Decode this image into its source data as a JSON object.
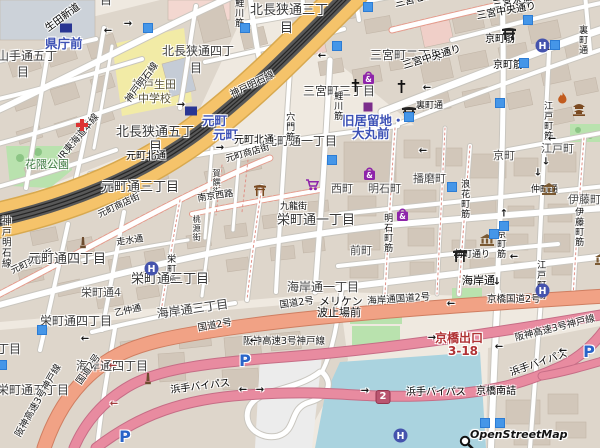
{
  "attribution": "OpenStreetMap",
  "colors": {
    "station_blue": "#3d51b5",
    "trunk_orange": "#f5c36a",
    "primary_salmon": "#f1a285",
    "motorway_pink": "#e88ba0",
    "water_blue": "#aad3df",
    "park_green": "#b9e2ae",
    "school_yellow": "#f2eba6",
    "poi_blue": "#4596e8",
    "shopping_purple": "#8e24aa",
    "exit_red": "#b03235"
  },
  "labels": [
    {
      "t": "山手通五丁",
      "x": -3,
      "y": 50,
      "c": "d12"
    },
    {
      "t": "目",
      "x": 17,
      "y": 66,
      "c": "d12"
    },
    {
      "t": "県庁前",
      "x": 45,
      "y": 38,
      "c": "stn"
    },
    {
      "t": "目",
      "x": 100,
      "y": -6,
      "c": "d12"
    },
    {
      "t": "北長狭通四丁",
      "x": 162,
      "y": 45,
      "c": "d12"
    },
    {
      "t": "目",
      "x": 190,
      "y": 62,
      "c": "d12"
    },
    {
      "t": "北長狭通三丁",
      "x": 250,
      "y": 4,
      "c": "d13"
    },
    {
      "t": "目",
      "x": 280,
      "y": 22,
      "c": "d13"
    },
    {
      "t": "生田新道",
      "x": 44,
      "y": 26,
      "c": "st10",
      "r": -36
    },
    {
      "t": "神戸生田",
      "x": 132,
      "y": 79,
      "c": "sch"
    },
    {
      "t": "中学校",
      "x": 138,
      "y": 93,
      "c": "sch"
    },
    {
      "t": "北長狭通五丁",
      "x": 116,
      "y": 126,
      "c": "d13"
    },
    {
      "t": "目",
      "x": 149,
      "y": 141,
      "c": "d13"
    },
    {
      "t": "三宮町二丁目",
      "x": 370,
      "y": 49,
      "c": "d12"
    },
    {
      "t": "三宮町三丁目",
      "x": 303,
      "y": 85,
      "c": "d12"
    },
    {
      "t": "三宮センター街",
      "x": 394,
      "y": 0,
      "c": "st10",
      "r": -13
    },
    {
      "t": "三宮本通",
      "x": 492,
      "y": 1,
      "c": "st10",
      "r": -8
    },
    {
      "t": "三宮中央通り",
      "x": 402,
      "y": 62,
      "c": "st10",
      "r": -17
    },
    {
      "t": "三宮中央通り",
      "x": 476,
      "y": 12,
      "c": "st10",
      "r": -10
    },
    {
      "t": "京町筋",
      "x": 485,
      "y": 35,
      "c": "st10"
    },
    {
      "t": "京町筋",
      "x": 493,
      "y": 61,
      "c": "st10"
    },
    {
      "t": "裏町通",
      "x": 577,
      "y": 25,
      "c": "st9",
      "v": 1
    },
    {
      "t": "裏町通",
      "x": 416,
      "y": 102,
      "c": "st9"
    },
    {
      "t": "鯉川筋",
      "x": 233,
      "y": -2,
      "c": "st9",
      "v": 1
    },
    {
      "t": "元町",
      "x": 202,
      "y": 115,
      "c": "stn"
    },
    {
      "t": "元町",
      "x": 213,
      "y": 129,
      "c": "stn"
    },
    {
      "t": "神戸明石線",
      "x": 124,
      "y": 99,
      "c": "rail",
      "r": -53
    },
    {
      "t": "神戸明石線",
      "x": 229,
      "y": 91,
      "c": "rail",
      "r": -26
    },
    {
      "t": "JR東海道本線",
      "x": 57,
      "y": 156,
      "c": "rail",
      "r": -50
    },
    {
      "t": "神戸明石線",
      "x": 0,
      "y": 216,
      "c": "rail",
      "v": 1
    },
    {
      "t": "旧居留地・",
      "x": 342,
      "y": 115,
      "c": "stn"
    },
    {
      "t": "大丸前",
      "x": 352,
      "y": 128,
      "c": "stn"
    },
    {
      "t": "元町通一丁目",
      "x": 265,
      "y": 135,
      "c": "d12"
    },
    {
      "t": "元町北通",
      "x": 126,
      "y": 152,
      "c": "st10"
    },
    {
      "t": "元町北通",
      "x": 234,
      "y": 136,
      "c": "st10"
    },
    {
      "t": "元町通三丁目",
      "x": 101,
      "y": 181,
      "c": "d13"
    },
    {
      "t": "花隈公園",
      "x": 25,
      "y": 159,
      "c": "park"
    },
    {
      "t": "元町商店街",
      "x": 225,
      "y": 156,
      "c": "st9",
      "r": -16
    },
    {
      "t": "元町商店街",
      "x": 97,
      "y": 212,
      "c": "st9",
      "r": -25
    },
    {
      "t": "元町商店街",
      "x": 10,
      "y": 268,
      "c": "st9",
      "r": -25
    },
    {
      "t": "穴門筋",
      "x": 284,
      "y": 112,
      "c": "st9",
      "v": 1
    },
    {
      "t": "鯉川筋",
      "x": 332,
      "y": 91,
      "c": "st9",
      "v": 1
    },
    {
      "t": "賀饌街",
      "x": 212,
      "y": 169,
      "c": "st8",
      "v": 1
    },
    {
      "t": "桃源街",
      "x": 192,
      "y": 215,
      "c": "st8",
      "v": 1
    },
    {
      "t": "南京西路",
      "x": 197,
      "y": 195,
      "c": "st9",
      "r": -8
    },
    {
      "t": "九龍街",
      "x": 280,
      "y": 203,
      "c": "st9"
    },
    {
      "t": "西町",
      "x": 331,
      "y": 183,
      "c": "d11"
    },
    {
      "t": "明石町",
      "x": 368,
      "y": 183,
      "c": "d11"
    },
    {
      "t": "播磨町",
      "x": 413,
      "y": 173,
      "c": "d11"
    },
    {
      "t": "京町",
      "x": 493,
      "y": 150,
      "c": "d11"
    },
    {
      "t": "江戸町",
      "x": 541,
      "y": 143,
      "c": "d11"
    },
    {
      "t": "伊藤町",
      "x": 568,
      "y": 194,
      "c": "d11"
    },
    {
      "t": "浪花町筋",
      "x": 459,
      "y": 179,
      "c": "st9",
      "v": 1
    },
    {
      "t": "明石町筋",
      "x": 382,
      "y": 213,
      "c": "st9",
      "v": 1
    },
    {
      "t": "江戸町筋",
      "x": 542,
      "y": 101,
      "c": "st9",
      "v": 1
    },
    {
      "t": "江戸町筋",
      "x": 535,
      "y": 260,
      "c": "st9",
      "v": 1
    },
    {
      "t": "伊藤町筋",
      "x": 573,
      "y": 207,
      "c": "st9",
      "v": 1
    },
    {
      "t": "京町筋",
      "x": 495,
      "y": 229,
      "c": "st9",
      "v": 1
    },
    {
      "t": "仲町通",
      "x": 531,
      "y": 186,
      "c": "st9"
    },
    {
      "t": "栄町通一丁目",
      "x": 277,
      "y": 214,
      "c": "d13"
    },
    {
      "t": "前町",
      "x": 350,
      "y": 245,
      "c": "d11"
    },
    {
      "t": "前町通り",
      "x": 454,
      "y": 251,
      "c": "st9"
    },
    {
      "t": "海岸通",
      "x": 462,
      "y": 275,
      "c": "st11"
    },
    {
      "t": "海岸通一丁目",
      "x": 287,
      "y": 281,
      "c": "d12"
    },
    {
      "t": "走水通",
      "x": 116,
      "y": 239,
      "c": "st9",
      "r": -8
    },
    {
      "t": "栄町通",
      "x": 165,
      "y": 254,
      "c": "st9",
      "v": 1
    },
    {
      "t": "元町通四丁目",
      "x": 28,
      "y": 253,
      "c": "d13"
    },
    {
      "t": "栄町通三丁目",
      "x": 131,
      "y": 273,
      "c": "d13"
    },
    {
      "t": "栄町通4",
      "x": 81,
      "y": 287,
      "c": "d11"
    },
    {
      "t": "栄町通四丁目",
      "x": 40,
      "y": 315,
      "c": "d12"
    },
    {
      "t": "乙仲通",
      "x": 114,
      "y": 310,
      "c": "st9",
      "r": -12
    },
    {
      "t": "海岸通三丁目",
      "x": 156,
      "y": 308,
      "c": "d12",
      "r": -8
    },
    {
      "t": "丁目",
      "x": -3,
      "y": 343,
      "c": "d12"
    },
    {
      "t": "海岸通四丁目",
      "x": 76,
      "y": 360,
      "c": "d12"
    },
    {
      "t": "栄町通五丁目",
      "x": -3,
      "y": 384,
      "c": "d12"
    },
    {
      "t": "国道2号",
      "x": 279,
      "y": 301,
      "c": "rail",
      "r": -8
    },
    {
      "t": "国道2号",
      "x": 197,
      "y": 324,
      "c": "rail",
      "r": -10
    },
    {
      "t": "国道2号",
      "x": 75,
      "y": 381,
      "c": "rail",
      "r": -55
    },
    {
      "t": "海岸通国道2号",
      "x": 367,
      "y": 297,
      "c": "rail",
      "r": -4
    },
    {
      "t": "京橋国道2号",
      "x": 487,
      "y": 295,
      "c": "rail"
    },
    {
      "t": "メリケン",
      "x": 319,
      "y": 296,
      "c": "blk11"
    },
    {
      "t": "波止場前",
      "x": 317,
      "y": 307,
      "c": "blk11"
    },
    {
      "t": "阪神高速3号神戸線",
      "x": 243,
      "y": 337,
      "c": "rail"
    },
    {
      "t": "阪神高速3号神戸線",
      "x": 514,
      "y": 334,
      "c": "rail",
      "r": -14
    },
    {
      "t": "阪神高速3号神戸線",
      "x": 14,
      "y": 434,
      "c": "rail",
      "r": -60
    },
    {
      "t": "京橋出口",
      "x": 435,
      "y": 332,
      "c": "red"
    },
    {
      "t": "3-18",
      "x": 448,
      "y": 345,
      "c": "red"
    },
    {
      "t": "浜手バイパス",
      "x": 170,
      "y": 386,
      "c": "st10",
      "r": -7
    },
    {
      "t": "浜手バイパス",
      "x": 406,
      "y": 388,
      "c": "st10"
    },
    {
      "t": "浜手バイパス",
      "x": 509,
      "y": 369,
      "c": "st10",
      "r": -19
    },
    {
      "t": "京橋南詰",
      "x": 476,
      "y": 387,
      "c": "st10"
    }
  ],
  "icons": [
    {
      "n": "hospital-icon",
      "x": 76,
      "y": 119
    },
    {
      "n": "railway-station-icon",
      "x": 66,
      "y": 28
    },
    {
      "n": "railway-station-icon",
      "x": 191,
      "y": 111
    },
    {
      "n": "hotel-icon",
      "x": 535,
      "y": 38
    },
    {
      "n": "hotel-icon",
      "x": 144,
      "y": 261
    },
    {
      "n": "hotel-icon",
      "x": 535,
      "y": 283
    },
    {
      "n": "hotel-icon",
      "x": 393,
      "y": 428
    },
    {
      "n": "museum-icon",
      "x": 542,
      "y": 183
    },
    {
      "n": "museum-icon",
      "x": 480,
      "y": 234
    },
    {
      "n": "museum-icon",
      "x": 595,
      "y": 253
    },
    {
      "n": "shrine-torii-icon",
      "x": 501,
      "y": 27
    },
    {
      "n": "shrine-torii-icon",
      "x": 401,
      "y": 106
    },
    {
      "n": "shrine-torii-icon",
      "x": 452,
      "y": 249
    },
    {
      "n": "chinatown-gate-icon",
      "x": 253,
      "y": 184
    },
    {
      "n": "church-icon",
      "x": 351,
      "y": 79
    },
    {
      "n": "church-icon",
      "x": 397,
      "y": 80
    },
    {
      "n": "fire-station-icon",
      "x": 557,
      "y": 92
    },
    {
      "n": "temple-icon",
      "x": 572,
      "y": 103
    },
    {
      "n": "shopping-bag-icon",
      "x": 362,
      "y": 70
    },
    {
      "n": "shopping-bag-icon",
      "x": 363,
      "y": 166
    },
    {
      "n": "shopping-bag-icon",
      "x": 396,
      "y": 207
    },
    {
      "n": "supermarket-cart-icon",
      "x": 305,
      "y": 179
    },
    {
      "n": "parking-icon",
      "x": 245,
      "y": 361
    },
    {
      "n": "parking-icon",
      "x": 125,
      "y": 437
    },
    {
      "n": "parking-icon",
      "x": 589,
      "y": 352
    },
    {
      "n": "monument-icon",
      "x": 79,
      "y": 237
    },
    {
      "n": "monument-icon",
      "x": 144,
      "y": 373
    },
    {
      "n": "poi-purple-icon",
      "x": 368,
      "y": 107
    },
    {
      "n": "poi-square-icon",
      "x": 148,
      "y": 28
    },
    {
      "n": "poi-square-icon",
      "x": 245,
      "y": 28
    },
    {
      "n": "poi-square-icon",
      "x": 368,
      "y": 7
    },
    {
      "n": "poi-square-icon",
      "x": 337,
      "y": 46
    },
    {
      "n": "poi-square-icon",
      "x": 528,
      "y": 20
    },
    {
      "n": "poi-square-icon",
      "x": 555,
      "y": 45
    },
    {
      "n": "poi-square-icon",
      "x": 500,
      "y": 103
    },
    {
      "n": "poi-square-icon",
      "x": 409,
      "y": 117
    },
    {
      "n": "poi-square-icon",
      "x": 452,
      "y": 187
    },
    {
      "n": "poi-square-icon",
      "x": 504,
      "y": 226
    },
    {
      "n": "poi-square-icon",
      "x": 494,
      "y": 234
    },
    {
      "n": "poi-square-icon",
      "x": 332,
      "y": 160
    },
    {
      "n": "poi-square-icon",
      "x": 524,
      "y": 63
    },
    {
      "n": "poi-square-icon",
      "x": 485,
      "y": 423
    },
    {
      "n": "poi-square-icon",
      "x": 500,
      "y": 423
    },
    {
      "n": "poi-square-icon",
      "x": 42,
      "y": 330
    },
    {
      "n": "poi-square-icon",
      "x": 2,
      "y": 365
    },
    {
      "n": "route-shield",
      "x": 383,
      "y": 397,
      "t": "2"
    },
    {
      "n": "magnifier-icon",
      "x": 459,
      "y": 435
    }
  ],
  "arrows": [
    {
      "x": 108,
      "y": 31,
      "g": "←"
    },
    {
      "x": 128,
      "y": 24,
      "g": "→"
    },
    {
      "x": 322,
      "y": 56,
      "g": "←"
    },
    {
      "x": 427,
      "y": 88,
      "g": "←"
    },
    {
      "x": 423,
      "y": 151,
      "g": "←"
    },
    {
      "x": 546,
      "y": 50,
      "g": "←"
    },
    {
      "x": 181,
      "y": 105,
      "g": "→"
    },
    {
      "x": 220,
      "y": 148,
      "g": "→"
    },
    {
      "x": 538,
      "y": 173,
      "g": "↓"
    },
    {
      "x": 546,
      "y": 162,
      "g": "↓"
    },
    {
      "x": 552,
      "y": 139,
      "g": "←"
    },
    {
      "x": 504,
      "y": 214,
      "g": "↑"
    },
    {
      "x": 514,
      "y": 257,
      "g": "←"
    },
    {
      "x": 497,
      "y": 282,
      "g": "↓"
    },
    {
      "x": 451,
      "y": 304,
      "g": "←"
    },
    {
      "x": 85,
      "y": 339,
      "g": "←"
    },
    {
      "x": 254,
      "y": 341,
      "g": "←"
    },
    {
      "x": 243,
      "y": 390,
      "g": "←"
    },
    {
      "x": 260,
      "y": 390,
      "g": "→"
    },
    {
      "x": 365,
      "y": 391,
      "g": "→"
    },
    {
      "x": 432,
      "y": 338,
      "g": "→"
    },
    {
      "x": 499,
      "y": 347,
      "g": "←"
    },
    {
      "x": 563,
      "y": 351,
      "g": "←"
    },
    {
      "x": 113,
      "y": 366,
      "g": "←",
      "c": "#a23b3b"
    },
    {
      "x": 114,
      "y": 404,
      "g": "←",
      "c": "#a23b3b"
    }
  ]
}
